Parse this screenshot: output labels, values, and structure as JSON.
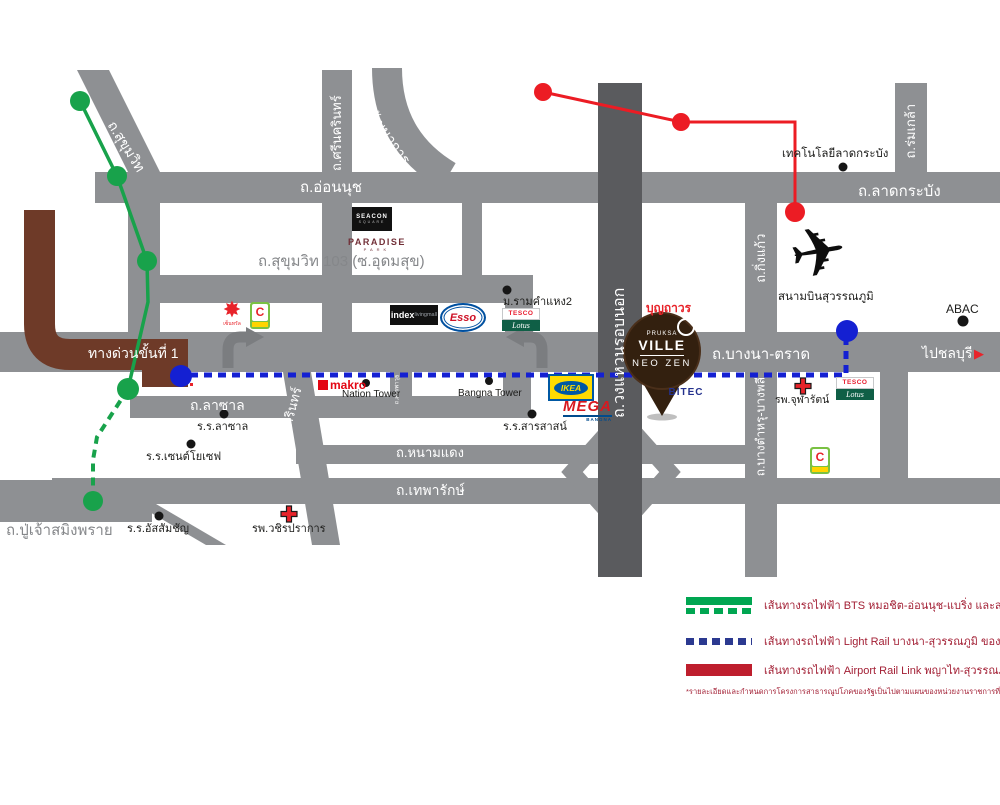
{
  "title": "Pruksa Ville Neo Zen location map",
  "colors": {
    "road_gray": "#8e9093",
    "ring_road_gray": "#5a5b5e",
    "expressway_brown": "#6e3a28",
    "bts_green": "#18a24b",
    "light_rail_blue": "#1420d2",
    "airport_link_red": "#ec1c24",
    "legend_green": "#00a651",
    "legend_blue": "#2b3990",
    "legend_red": "#be1e2d",
    "legend_text": "#a32035",
    "pin_brown": "#33200f"
  },
  "icons": {
    "airplane": "✈",
    "chonburi_arrow": "▶",
    "central_star": "✸"
  },
  "roads": {
    "onnut": "ถ.อ่อนนุช",
    "latkrabang": "ถ.ลาดกระบัง",
    "sukhumvit103": "ถ.สุขุมวิท 103 (ซ.อุดมสุข)",
    "bangna_trad": "ถ.บางนา-ตราด",
    "to_chonburi": "ไปชลบุรี",
    "expressway": "ทางด่วนขั้นที่ 1",
    "lasalle": "ถ.ลาซาล",
    "namdaeng": "ถ.หนามแดง",
    "thepharak": "ถ.เทพารักษ์",
    "puchao": "ถ.ปู่เจ้าสมิงพราย",
    "srinakarin_top": "ถ.ศรีนครินทร์",
    "srinakarin_bottom": "ถ.ศรีนครินทร์",
    "sukhumvit": "ถ.สุขุมวิท",
    "phatthanakan": "ถ.พัฒนาการ",
    "ring_road": "ถ.วงแหวนรอบนอก",
    "king_kaeo": "ถ.กิ่งแก้ว",
    "rom_klao": "ถ.ร่มเกล้า",
    "bang_tamru": "ถ.บางตำหรุ-บางพลี",
    "sanphawut": "ถ.สรรพาวุธ"
  },
  "landmarks": {
    "tech_ladkrabang": "เทคโนโลยีลาดกระบัง",
    "abac": "ABAC",
    "suvarnabhumi": "สนามบินสุวรรณภูมิ",
    "ramkhamhaeng2": "ม.รามคำแหง2",
    "nation_tower": "Nation Tower",
    "bangna_tower": "Bangna Tower",
    "lasalle_school": "ร.ร.ลาซาล",
    "st_joseph_school": "ร.ร.เซนต์โยเซฟ",
    "sarasas_school": "ร.ร.สารสาสน์",
    "assumption_school": "ร.ร.อัสสัมชัญ",
    "vajira_hospital": "รพ.วชิรปราการ",
    "chularat_hospital": "รพ.จุฬารัตน์"
  },
  "logos": {
    "central": "เซ็นทรัล",
    "bigc": "C",
    "seacon": "SEACON",
    "seacon_sub": "SQUARE",
    "paradise": "PARADISE",
    "paradise_sub": "PARK",
    "index": "index",
    "index_sub": "livingmall",
    "esso": "Esso",
    "tesco": "TESCO",
    "lotus": "Lotus",
    "makro": "makro",
    "ikea": "IKEA",
    "mega": "MEGA",
    "mega_sub": "BANGNA",
    "boonthavorn": "บุญถาวร",
    "bitec": "BITEC"
  },
  "pin": {
    "brand_top": "PRUKSA",
    "brand_mid": "VILLE",
    "brand_bottom": "NEO ZEN"
  },
  "legend": {
    "items": [
      {
        "label": "เส้นทางรถไฟฟ้า BTS หมอชิต-อ่อนนุช-แบริ่ง และส่วนขยาย",
        "color": "#00a651",
        "style": "solid+dashed"
      },
      {
        "label": "เส้นทางรถไฟฟ้า Light Rail บางนา-สุวรรณภูมิ ของ กทม.",
        "color": "#2b3990",
        "style": "dashed"
      },
      {
        "label": "เส้นทางรถไฟฟ้า Airport Rail Link พญาไท-สุวรรณภูมิ",
        "color": "#be1e2d",
        "style": "solid"
      }
    ],
    "footnote": "*รายละเอียดและกำหนดการโครงการสาธารณูปโภคของรัฐเป็นไปตามแผนของหน่วยงานราชการที่เกี่ยวข้อง"
  }
}
